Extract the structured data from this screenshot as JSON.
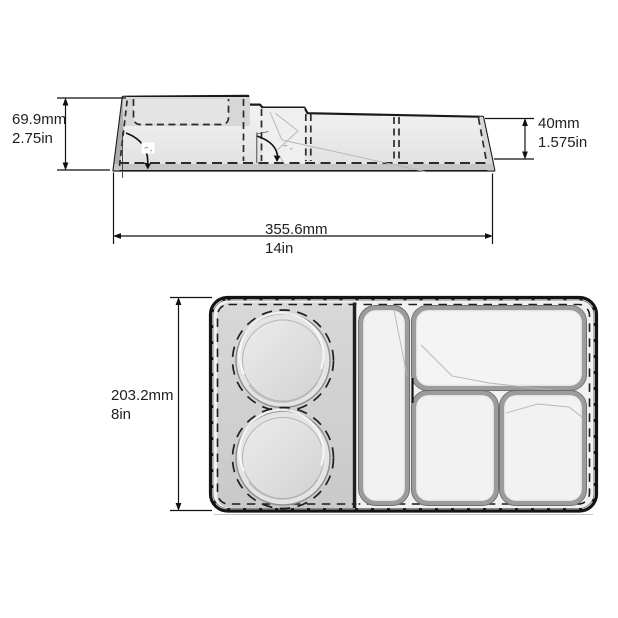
{
  "page": {
    "description": "Technical dimension drawing of a 5-compartment food tray: side profile view (top) and top plan view (bottom)"
  },
  "side_view": {
    "dim_height_left": {
      "mm": "69.9mm",
      "inches": "2.75in"
    },
    "dim_height_right": {
      "mm": "40mm",
      "inches": "1.575in"
    },
    "dim_width": {
      "mm": "355.6mm",
      "inches": "14in"
    }
  },
  "top_view": {
    "dim_height": {
      "mm": "203.2mm",
      "inches": "8in"
    },
    "compartments": [
      "large-round-well-upper",
      "large-round-well-lower",
      "narrow-vertical-well",
      "top-right-well",
      "bottom-middle-well",
      "bottom-right-well"
    ]
  },
  "colors": {
    "line": "#1a1a1a",
    "dim_text": "#1f1f1f",
    "fill_light": "#f1f1f1",
    "fill_mid": "#d9d9d9",
    "fill_dark": "#c0c0c0"
  }
}
